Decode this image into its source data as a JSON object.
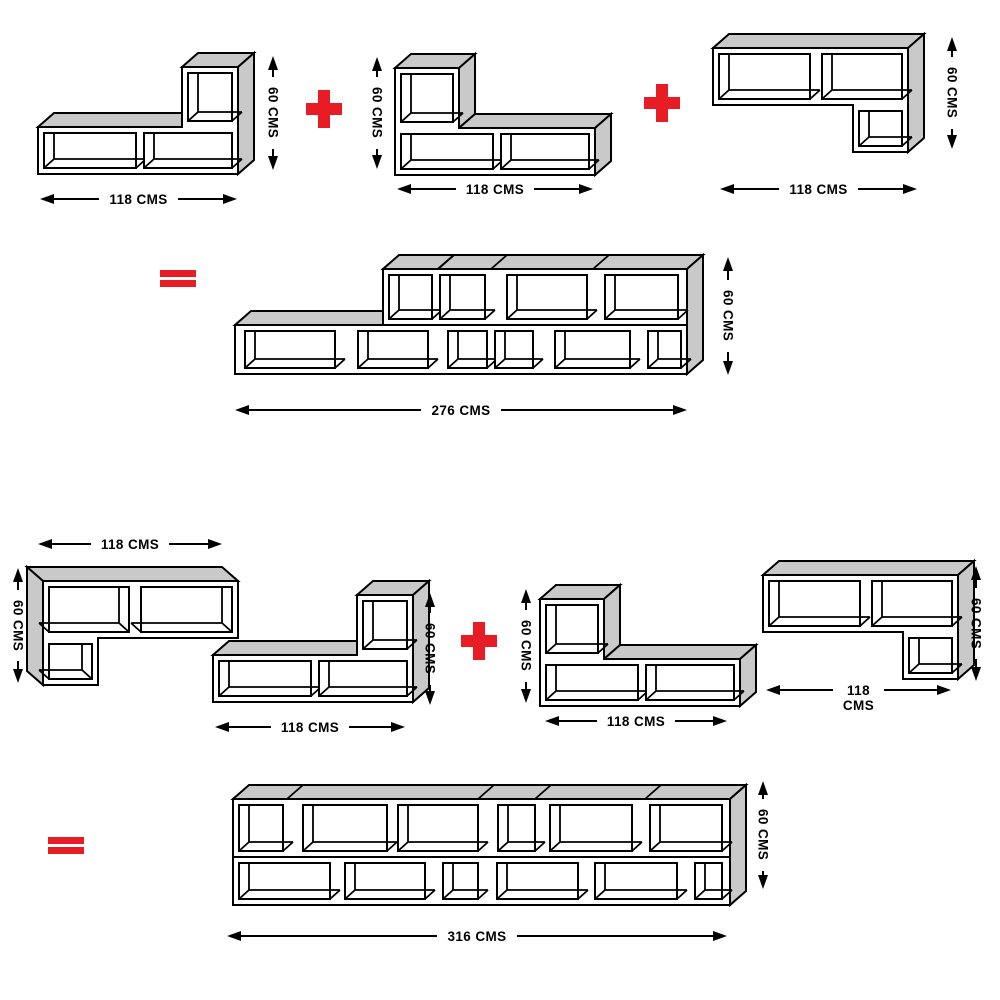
{
  "colors": {
    "accent_red": "#e81c24",
    "panel_gray": "#c9c9c9",
    "line_black": "#000000",
    "background": "#ffffff"
  },
  "operators": {
    "plus": "+",
    "equals": "="
  },
  "equation1": {
    "unit1": {
      "name": "L-shelf with cube at right",
      "width_label": "118 CMS",
      "height_label": "60 CMS"
    },
    "unit2": {
      "name": "L-shelf with cube at left",
      "width_label": "118 CMS",
      "height_label": "60 CMS"
    },
    "unit3": {
      "name": "Top shelf with hanging cube at right",
      "width_label": "118 CMS",
      "height_label": "60 CMS"
    },
    "result": {
      "name": "Stepped combined wall unit",
      "width_label": "276 CMS",
      "height_label": "60 CMS"
    }
  },
  "equation2": {
    "unitA": {
      "name": "Top shelf with hanging cube at left",
      "width_label": "118 CMS",
      "height_label": "60 CMS"
    },
    "unitB": {
      "name": "L-shelf with cube at right",
      "width_label": "118 CMS",
      "height_label": "60 CMS"
    },
    "unitC": {
      "name": "L-shelf with cube at left",
      "width_label": "118 CMS",
      "height_label": "60 CMS"
    },
    "unitD": {
      "name": "Top shelf with hanging cube at right",
      "width_label_line1": "118",
      "width_label_line2": "CMS",
      "height_label": "60 CMS"
    },
    "result": {
      "name": "Long combined wall unit",
      "width_label": "316 CMS",
      "height_label": "60 CMS"
    }
  }
}
